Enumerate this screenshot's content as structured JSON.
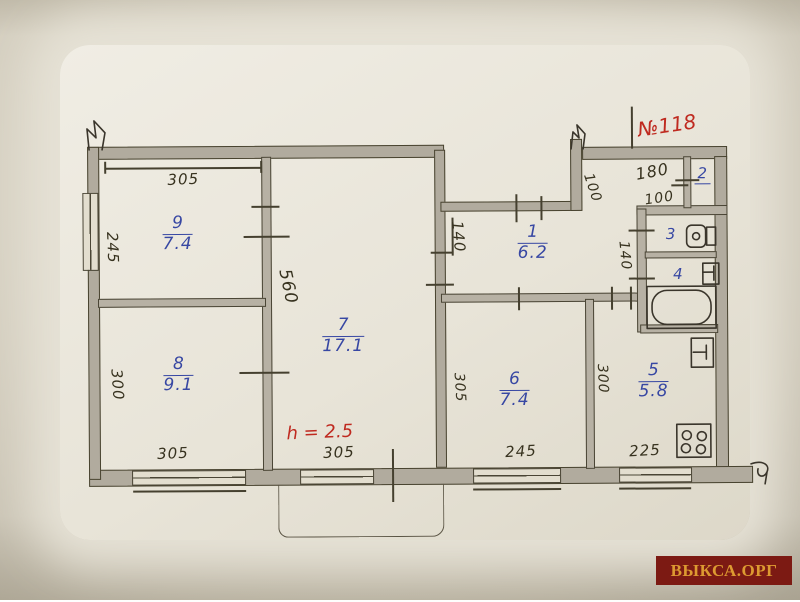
{
  "annotations": {
    "apartment_number": "№118",
    "height_note": "h = 2.5"
  },
  "watermark": {
    "text": "ВЫКСА.ОРГ",
    "bg_color": "#7c1a13",
    "text_color": "#dd9a31"
  },
  "colors": {
    "ink": "#45402f",
    "wall_fill": "#b1ab9e",
    "blue": "#3747a3",
    "red": "#bf2a20",
    "paper": "#e8e4d8"
  },
  "rooms": [
    {
      "number": "9",
      "area": "7.4"
    },
    {
      "number": "8",
      "area": "9.1"
    },
    {
      "number": "7",
      "area": "17.1"
    },
    {
      "number": "1",
      "area": "6.2"
    },
    {
      "number": "6",
      "area": "7.4"
    },
    {
      "number": "5",
      "area": "5.8"
    },
    {
      "number": "2",
      "area": ""
    },
    {
      "number": "3",
      "area": ""
    },
    {
      "number": "4",
      "area": ""
    }
  ],
  "dims": [
    {
      "value": "305"
    },
    {
      "value": "245"
    },
    {
      "value": "300"
    },
    {
      "value": "305"
    },
    {
      "value": "560"
    },
    {
      "value": "305"
    },
    {
      "value": "140"
    },
    {
      "value": "100"
    },
    {
      "value": "180"
    },
    {
      "value": "100"
    },
    {
      "value": "140"
    },
    {
      "value": "305"
    },
    {
      "value": "245"
    },
    {
      "value": "300"
    },
    {
      "value": "225"
    }
  ],
  "icons": [
    "toilet-icon",
    "sink-icon",
    "bathtub-icon",
    "kitchen-sink-icon",
    "stove-icon"
  ]
}
